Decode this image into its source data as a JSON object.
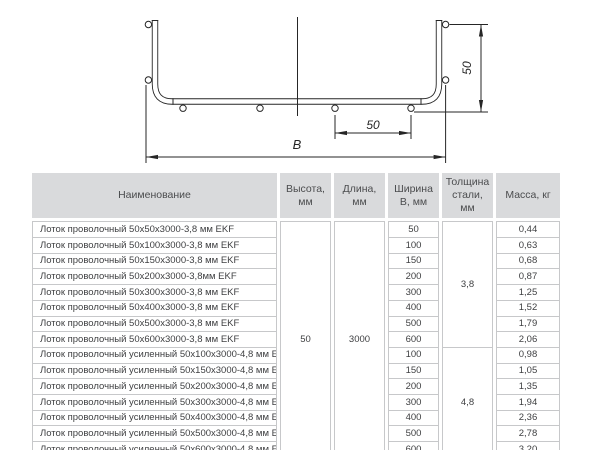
{
  "diagram": {
    "height_dim": "50",
    "wire_spacing_dim": "50",
    "width_dim": "B"
  },
  "table": {
    "headers": {
      "name": "Наименование",
      "height": "Высота, мм",
      "length": "Длина, мм",
      "width": "Ширина В, мм",
      "thickness": "Толщина стали, мм",
      "mass": "Масса, кг"
    },
    "height_mm": "50",
    "length_mm": "3000",
    "groups": [
      {
        "thickness": "3,8",
        "rows": [
          {
            "name": "Лоток проволочный 50х50х3000-3,8 мм EKF",
            "width": "50",
            "mass": "0,44"
          },
          {
            "name": "Лоток проволочный 50х100х3000-3,8 мм EKF",
            "width": "100",
            "mass": "0,63"
          },
          {
            "name": "Лоток проволочный 50х150х3000-3,8 мм EKF",
            "width": "150",
            "mass": "0,68"
          },
          {
            "name": "Лоток проволочный 50х200х3000-3,8мм EKF",
            "width": "200",
            "mass": "0,87"
          },
          {
            "name": "Лоток проволочный 50х300х3000-3,8 мм EKF",
            "width": "300",
            "mass": "1,25"
          },
          {
            "name": "Лоток проволочный 50х400х3000-3,8 мм EKF",
            "width": "400",
            "mass": "1,52"
          },
          {
            "name": "Лоток проволочный 50х500х3000-3,8 мм EKF",
            "width": "500",
            "mass": "1,79"
          },
          {
            "name": "Лоток проволочный 50х600х3000-3,8 мм EKF",
            "width": "600",
            "mass": "2,06"
          }
        ]
      },
      {
        "thickness": "4,8",
        "rows": [
          {
            "name": "Лоток проволочный усиленный 50х100х3000-4,8 мм EKF",
            "width": "100",
            "mass": "0,98"
          },
          {
            "name": "Лоток проволочный усиленный 50х150х3000-4,8 мм EKF",
            "width": "150",
            "mass": "1,05"
          },
          {
            "name": "Лоток проволочный усиленный 50х200х3000-4,8 мм EKF",
            "width": "200",
            "mass": "1,35"
          },
          {
            "name": "Лоток проволочный усиленный 50х300х3000-4,8 мм EKF",
            "width": "300",
            "mass": "1,94"
          },
          {
            "name": "Лоток проволочный усиленный 50х400х3000-4,8 мм EKF",
            "width": "400",
            "mass": "2,36"
          },
          {
            "name": "Лоток проволочный усиленный 50х500х3000-4,8 мм EKF",
            "width": "500",
            "mass": "2,78"
          },
          {
            "name": "Лоток проволочный усиленный 50х600х3000-4,8 мм EKF",
            "width": "600",
            "mass": "3,20"
          }
        ]
      }
    ]
  },
  "colors": {
    "header_bg": "#d9dadc",
    "border": "#c7c8ca",
    "header_text": "#4b4c4e",
    "body_text": "#3e3f41",
    "line": "#262626"
  }
}
